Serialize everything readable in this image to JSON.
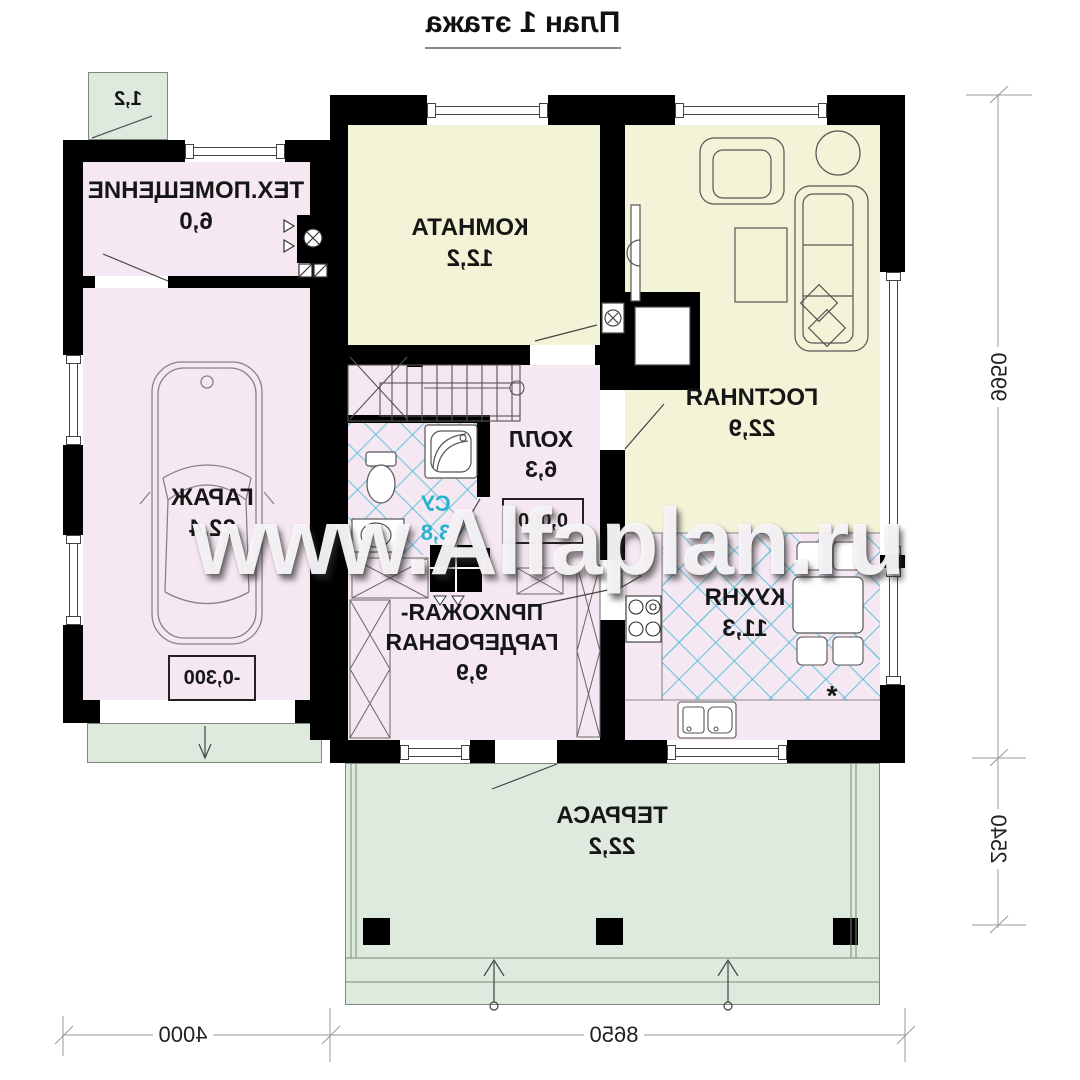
{
  "title": "План 1 этажа",
  "watermark": "www.Alfaplan.ru",
  "porch_area": "1,2",
  "rooms": {
    "tech": {
      "name": "ТЕХ.ПОМЕЩЕНИЕ",
      "area": "6,0"
    },
    "komnata": {
      "name": "КОМНАТА",
      "area": "12,2"
    },
    "gostinaya": {
      "name": "ГОСТИНАЯ",
      "area": "22,9"
    },
    "garage": {
      "name": "ГАРАЖ",
      "area": "22,4",
      "level": "-0,300"
    },
    "hall": {
      "name": "ХОЛЛ",
      "area": "6,3",
      "level": "0,000"
    },
    "su": {
      "name": "СУ",
      "area": "3,8"
    },
    "hallway": {
      "name_line1": "ПРИХОЖАЯ-",
      "name_line2": "ГАРДЕРОБНАЯ",
      "area": "9,9"
    },
    "kitchen": {
      "name": "КУХНЯ",
      "area": "11,3",
      "mark": "*"
    },
    "terrace": {
      "name": "ТЕРРАСА",
      "area": "22,2"
    }
  },
  "dimensions": {
    "right_top": "9950",
    "right_bottom": "2540",
    "bottom_left": "4000",
    "bottom_right": "8650"
  },
  "colors": {
    "wall": "#000000",
    "room_pink": "#f6e8f2",
    "room_yellow": "#f3f4d7",
    "outdoor_green": "#dfeadf",
    "tile_cyan": "#35b6d4",
    "su_text": "#29b2cf"
  }
}
